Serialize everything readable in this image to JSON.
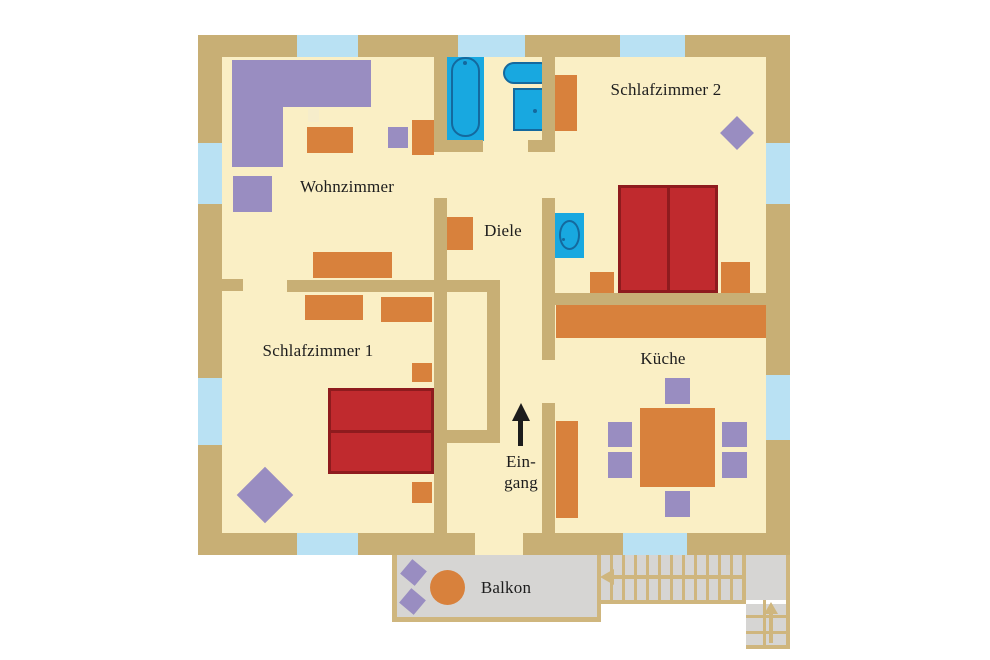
{
  "rooms": {
    "wohnzimmer": {
      "label": "Wohnzimmer"
    },
    "schlafzimmer2": {
      "label": "Schlafzimmer 2"
    },
    "diele": {
      "label": "Diele"
    },
    "schlafzimmer1": {
      "label": "Schlafzimmer 1"
    },
    "kueche": {
      "label": "Küche"
    },
    "eingang": {
      "label_line1": "Ein-",
      "label_line2": "gang"
    },
    "balkon": {
      "label": "Balkon"
    }
  },
  "colors": {
    "background": "#FFFFFF",
    "wall": "#C8AF75",
    "floor": "#FAEFC5",
    "window": "#B9E1F3",
    "furniture_orange": "#D8813C",
    "furniture_purple": "#998DC1",
    "bed_red": "#C02A2E",
    "bed_border": "#8E1B1E",
    "fixture_blue": "#18A8E0",
    "fixture_border": "#14699E",
    "balcony_floor": "#D6D5D3",
    "stair_line": "#CFB67E",
    "arrow_black": "#1C1C1C",
    "text": "#1D1D1D",
    "side_table": "#F6EDCB"
  },
  "icons": {
    "entrance_arrow": "arrow-up",
    "stair_arrow_main": "arrow-left",
    "stair_arrow_side": "arrow-up"
  }
}
